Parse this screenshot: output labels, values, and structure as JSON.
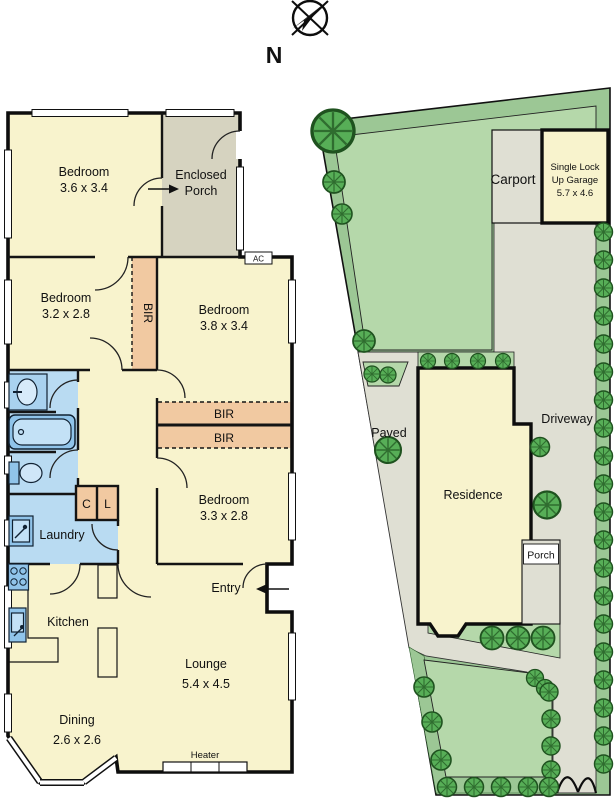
{
  "colors": {
    "room_cream": "#f8f3cd",
    "porch_grey": "#d6d3c0",
    "wardrobe_peach": "#f1c9a1",
    "wet_area_blue": "#b9dbf2",
    "fixture_blue": "#90c4ea",
    "fixture_light_blue": "#d7ebfa",
    "wall_black": "#0d0d0d",
    "lawn_light_green": "#b5d8aa",
    "site_green": "#9cc795",
    "bush_green": "#57ae57",
    "bush_dark_green": "#1f521f",
    "hardstand_grey": "#dfdfd3",
    "white": "#ffffff"
  },
  "compass": {
    "north_label": "N"
  },
  "floor_plan": {
    "bedroom1": {
      "name": "Bedroom",
      "dims": "3.6 x 3.4"
    },
    "enclosed_porch": {
      "line1": "Enclosed",
      "line2": "Porch"
    },
    "bedroom2": {
      "name": "Bedroom",
      "dims": "3.2 x 2.8"
    },
    "bedroom3": {
      "name": "Bedroom",
      "dims": "3.8 x 3.4"
    },
    "bedroom4": {
      "name": "Bedroom",
      "dims": "3.3 x 2.8"
    },
    "bir_side": "BIR",
    "bir_top": "BIR",
    "bir_bottom": "BIR",
    "closet_c": "C",
    "closet_l": "L",
    "laundry": "Laundry",
    "kitchen": "Kitchen",
    "dining": {
      "name": "Dining",
      "dims": "2.6 x 2.6"
    },
    "lounge": {
      "name": "Lounge",
      "dims": "5.4 x 4.5"
    },
    "entry": "Entry",
    "heater": "Heater",
    "ac": "AC"
  },
  "site_plan": {
    "carport": "Carport",
    "garage": {
      "line1": "Single Lock",
      "line2": "Up Garage",
      "dims": "5.7 x 4.6"
    },
    "paved": "Paved",
    "driveway": "Driveway",
    "residence": "Residence",
    "porch": "Porch"
  }
}
